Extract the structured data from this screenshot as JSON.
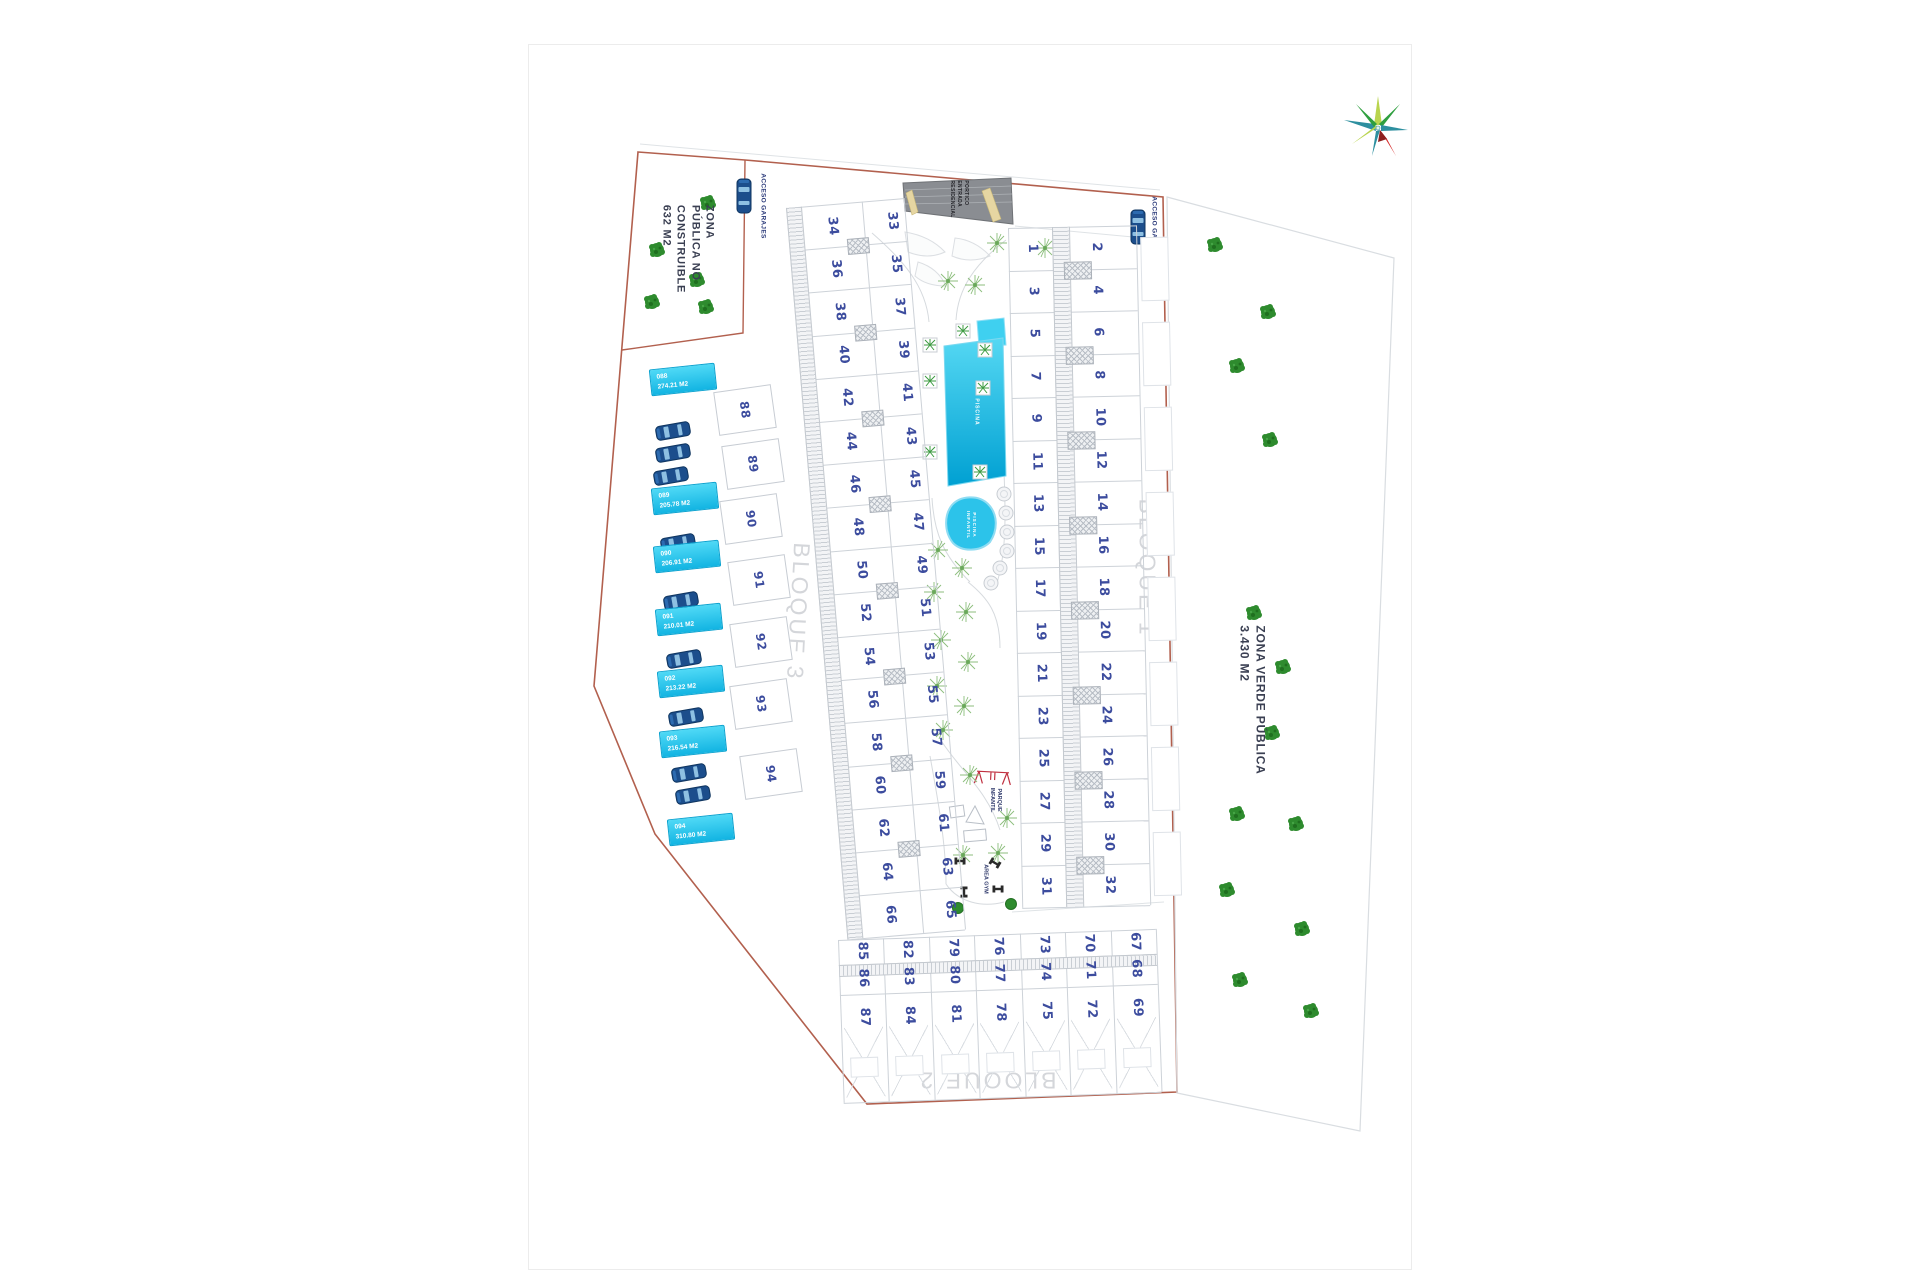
{
  "title": "Residential development master site plan",
  "plan": {
    "zone_left_label": "ZONA\nPÚBLICA NO\nCONSTRUIBLE\n632 M2",
    "zone_right_label": "ZONA VERDE PÚBLICA\n3.430 M2",
    "acceso_garajes_left": "ACCESO GARAJES",
    "acceso_garajes_right": "ACCESO GARAJES",
    "entrance_label": "PORTICO\nENTRADA\nRESIDENCIAL",
    "pool_label": "PISCINA",
    "kids_pool_label": "PISCINA\nINFANTIL",
    "playground_label": "PARQUE\nINFANTIL",
    "gym_label": "AREA GYM",
    "block_labels": {
      "block1": "BLOQUE 1",
      "block2": "BLOQUE 2",
      "block3": "BLOQUE 3"
    },
    "plots": {
      "block1_inner": [
        "1",
        "3",
        "5",
        "7",
        "9",
        "11",
        "13",
        "15",
        "17",
        "19",
        "21",
        "23",
        "25",
        "27",
        "29",
        "31"
      ],
      "block1_outer": [
        "2",
        "4",
        "6",
        "8",
        "10",
        "12",
        "14",
        "16",
        "18",
        "20",
        "22",
        "24",
        "26",
        "28",
        "30",
        "32"
      ],
      "block3_outer": [
        "34",
        "36",
        "38",
        "40",
        "42",
        "44",
        "46",
        "48",
        "50",
        "52",
        "54",
        "56",
        "58",
        "60",
        "62",
        "64",
        "66"
      ],
      "block3_inner": [
        "33",
        "35",
        "37",
        "39",
        "41",
        "43",
        "45",
        "47",
        "49",
        "51",
        "53",
        "55",
        "57",
        "59",
        "61",
        "63",
        "65"
      ],
      "block2_columns": [
        [
          "85",
          "86",
          "87"
        ],
        [
          "82",
          "83",
          "84"
        ],
        [
          "79",
          "80",
          "81"
        ],
        [
          "76",
          "77",
          "78"
        ],
        [
          "73",
          "74",
          "75"
        ],
        [
          "70",
          "71",
          "72"
        ],
        [
          "67",
          "68",
          "69"
        ]
      ],
      "villas": [
        "88",
        "89",
        "90",
        "91",
        "92",
        "93",
        "94"
      ]
    },
    "villa_tags": [
      {
        "code": "088",
        "area": "274.21 M2"
      },
      {
        "code": "089",
        "area": "205.78 M2"
      },
      {
        "code": "090",
        "area": "206.91 M2"
      },
      {
        "code": "091",
        "area": "210.01 M2"
      },
      {
        "code": "092",
        "area": "213.22 M2"
      },
      {
        "code": "093",
        "area": "216.54 M2"
      },
      {
        "code": "094",
        "area": "310.80 M2"
      }
    ],
    "colors": {
      "boundary_red": "#b2604e",
      "plot_number_blue": "#3c4c9e",
      "pool_cyan": "#00a8d8",
      "tag_cyan": "#2ec9ef",
      "tree_green": "#2e8b2e",
      "building_line_gray": "#cdd2d8"
    }
  }
}
